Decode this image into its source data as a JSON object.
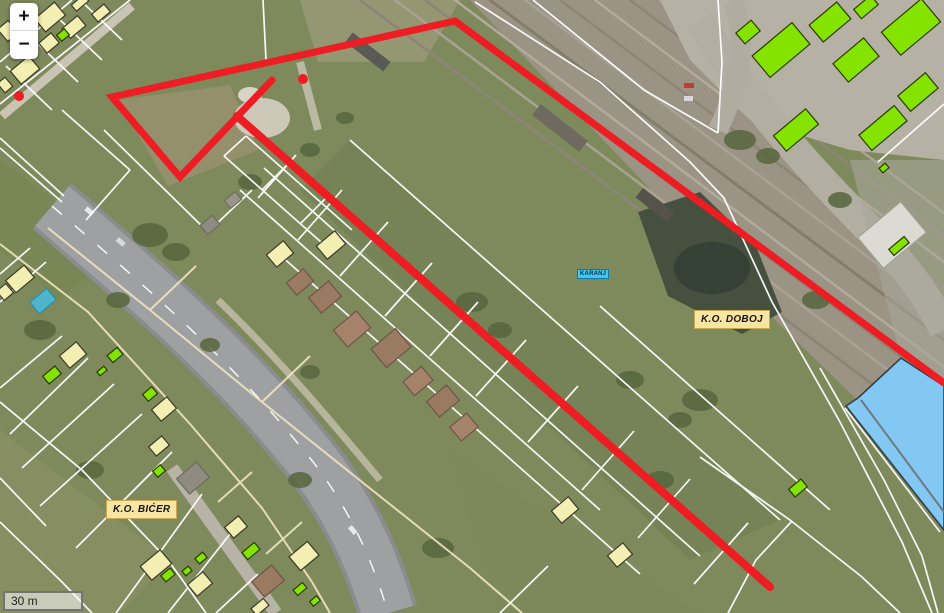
{
  "controls": {
    "zoom_in_label": "+",
    "zoom_out_label": "−"
  },
  "scale_bar": {
    "label": "30 m"
  },
  "labels": {
    "ko_doboj": "K.O. DOBOJ",
    "ko_bicer": "K.O. BIĆER",
    "karanj": "KARANJ"
  },
  "colors": {
    "boundary_red": "#ee1c23",
    "parcel_white": "#ffffff",
    "parcel_cream": "#f2e4c2",
    "building_yellow": "#f3efb2",
    "building_green": "#84e300",
    "building_blue": "#82c8f2",
    "label_bg": "#f8e5a3",
    "hydro_label_bg": "#41c7f0"
  },
  "map_features": {
    "red_boundary": {
      "main_polyline": [
        [
          944,
          383
        ],
        [
          455,
          21
        ],
        [
          112,
          97
        ],
        [
          180,
          177
        ],
        [
          272,
          80
        ]
      ],
      "branch_line": [
        [
          237,
          116
        ],
        [
          770,
          587
        ]
      ],
      "dots": [
        [
          303,
          79
        ],
        [
          19,
          96
        ]
      ]
    },
    "parcel_lines_white": [
      [
        [
          0,
          104
        ],
        [
          130,
          0
        ]
      ],
      [
        [
          0,
          62
        ],
        [
          72,
          0
        ]
      ],
      [
        [
          30,
          36
        ],
        [
          78,
          82
        ]
      ],
      [
        [
          56,
          16
        ],
        [
          102,
          60
        ]
      ],
      [
        [
          80,
          0
        ],
        [
          122,
          40
        ]
      ],
      [
        [
          6,
          66
        ],
        [
          52,
          110
        ]
      ],
      [
        [
          0,
          138
        ],
        [
          64,
          196
        ]
      ],
      [
        [
          62,
          110
        ],
        [
          130,
          170
        ]
      ],
      [
        [
          130,
          170
        ],
        [
          86,
          220
        ]
      ],
      [
        [
          104,
          130
        ],
        [
          208,
          232
        ]
      ],
      [
        [
          208,
          232
        ],
        [
          252,
          190
        ]
      ],
      [
        [
          263,
          0
        ],
        [
          266,
          60
        ]
      ],
      [
        [
          224,
          156
        ],
        [
          330,
          250
        ]
      ],
      [
        [
          246,
          136
        ],
        [
          352,
          230
        ]
      ],
      [
        [
          262,
          190
        ],
        [
          288,
          164
        ]
      ],
      [
        [
          300,
          224
        ],
        [
          326,
          198
        ]
      ],
      [
        [
          224,
          156
        ],
        [
          246,
          136
        ]
      ],
      [
        [
          240,
          190
        ],
        [
          600,
          510
        ]
      ],
      [
        [
          264,
          168
        ],
        [
          700,
          556
        ]
      ],
      [
        [
          280,
          255
        ],
        [
          640,
          574
        ]
      ],
      [
        [
          350,
          140
        ],
        [
          780,
          520
        ]
      ],
      [
        [
          600,
          306
        ],
        [
          830,
          510
        ]
      ],
      [
        [
          298,
          240
        ],
        [
          342,
          190
        ]
      ],
      [
        [
          340,
          276
        ],
        [
          388,
          222
        ]
      ],
      [
        [
          385,
          316
        ],
        [
          432,
          263
        ]
      ],
      [
        [
          430,
          356
        ],
        [
          478,
          302
        ]
      ],
      [
        [
          476,
          396
        ],
        [
          526,
          340
        ]
      ],
      [
        [
          528,
          442
        ],
        [
          578,
          386
        ]
      ],
      [
        [
          582,
          490
        ],
        [
          634,
          431
        ]
      ],
      [
        [
          638,
          538
        ],
        [
          690,
          479
        ]
      ],
      [
        [
          694,
          584
        ],
        [
          748,
          523
        ]
      ],
      [
        [
          258,
          198
        ],
        [
          296,
          155
        ]
      ],
      [
        [
          475,
          2
        ],
        [
          600,
          82
        ],
        [
          690,
          162
        ],
        [
          724,
          198
        ],
        [
          772,
          302
        ],
        [
          840,
          422
        ],
        [
          902,
          542
        ],
        [
          932,
          613
        ]
      ],
      [
        [
          533,
          0
        ],
        [
          644,
          90
        ],
        [
          718,
          133
        ]
      ],
      [
        [
          718,
          133
        ],
        [
          722,
          62
        ],
        [
          718,
          0
        ]
      ],
      [
        [
          878,
          162
        ],
        [
          944,
          104
        ]
      ],
      [
        [
          820,
          368
        ],
        [
          884,
          480
        ],
        [
          922,
          556
        ],
        [
          938,
          613
        ]
      ],
      [
        [
          700,
          457
        ],
        [
          790,
          520
        ],
        [
          862,
          577
        ],
        [
          900,
          613
        ]
      ],
      [
        [
          792,
          521
        ],
        [
          756,
          560
        ],
        [
          728,
          613
        ]
      ],
      [
        [
          845,
          408
        ],
        [
          940,
          532
        ]
      ],
      [
        [
          0,
          402
        ],
        [
          82,
          470
        ],
        [
          168,
          560
        ],
        [
          206,
          613
        ]
      ],
      [
        [
          62,
          336
        ],
        [
          0,
          388
        ]
      ],
      [
        [
          88,
          358
        ],
        [
          10,
          434
        ]
      ],
      [
        [
          114,
          384
        ],
        [
          22,
          468
        ]
      ],
      [
        [
          142,
          414
        ],
        [
          40,
          506
        ]
      ],
      [
        [
          172,
          452
        ],
        [
          76,
          548
        ]
      ],
      [
        [
          202,
          494
        ],
        [
          116,
          613
        ]
      ],
      [
        [
          230,
          534
        ],
        [
          168,
          613
        ]
      ],
      [
        [
          258,
          574
        ],
        [
          216,
          613
        ]
      ],
      [
        [
          46,
          262
        ],
        [
          0,
          302
        ]
      ],
      [
        [
          30,
          248
        ],
        [
          0,
          274
        ]
      ],
      [
        [
          0,
          522
        ],
        [
          62,
          582
        ],
        [
          92,
          613
        ]
      ],
      [
        [
          0,
          478
        ],
        [
          46,
          526
        ]
      ],
      [
        [
          0,
          148
        ],
        [
          62,
          202
        ]
      ],
      [
        [
          500,
          613
        ],
        [
          548,
          566
        ]
      ]
    ],
    "parcel_lines_cream": [
      [
        [
          48,
          228
        ],
        [
          150,
          310
        ],
        [
          262,
          402
        ],
        [
          362,
          482
        ],
        [
          470,
          568
        ],
        [
          522,
          613
        ]
      ],
      [
        [
          0,
          244
        ],
        [
          88,
          312
        ],
        [
          190,
          424
        ],
        [
          262,
          508
        ],
        [
          312,
          582
        ],
        [
          330,
          613
        ]
      ],
      [
        [
          252,
          472
        ],
        [
          218,
          502
        ]
      ],
      [
        [
          302,
          522
        ],
        [
          266,
          554
        ]
      ],
      [
        [
          150,
          310
        ],
        [
          196,
          266
        ]
      ],
      [
        [
          262,
          402
        ],
        [
          310,
          356
        ]
      ]
    ],
    "buildings_yellow": [
      [
        50,
        17,
        26,
        17
      ],
      [
        74,
        27,
        20,
        13
      ],
      [
        101,
        13,
        16,
        10
      ],
      [
        49,
        43,
        16,
        13
      ],
      [
        25,
        70,
        24,
        17
      ],
      [
        8,
        31,
        14,
        16
      ],
      [
        5,
        85,
        10,
        12
      ],
      [
        80,
        3,
        16,
        8
      ],
      [
        20,
        279,
        24,
        16
      ],
      [
        5,
        292,
        12,
        12
      ],
      [
        73,
        355,
        22,
        16
      ],
      [
        164,
        409,
        20,
        15
      ],
      [
        159,
        446,
        17,
        12
      ],
      [
        280,
        254,
        22,
        16
      ],
      [
        331,
        245,
        24,
        17
      ],
      [
        156,
        565,
        26,
        18
      ],
      [
        200,
        584,
        20,
        15
      ],
      [
        236,
        527,
        18,
        14
      ],
      [
        304,
        556,
        24,
        18
      ],
      [
        565,
        510,
        22,
        16
      ],
      [
        620,
        555,
        20,
        15
      ],
      [
        260,
        607,
        16,
        9
      ]
    ],
    "buildings_green": [
      [
        63,
        35,
        10,
        8
      ],
      [
        52,
        375,
        16,
        10
      ],
      [
        115,
        355,
        13,
        9
      ],
      [
        102,
        371,
        9,
        5
      ],
      [
        150,
        394,
        12,
        9
      ],
      [
        159,
        471,
        10,
        8
      ],
      [
        168,
        575,
        12,
        8
      ],
      [
        201,
        558,
        10,
        7
      ],
      [
        187,
        571,
        8,
        6
      ],
      [
        251,
        551,
        16,
        9
      ],
      [
        300,
        589,
        12,
        7
      ],
      [
        315,
        601,
        9,
        6
      ],
      [
        798,
        488,
        16,
        10
      ],
      [
        884,
        168,
        8,
        6
      ],
      [
        899,
        246,
        20,
        8
      ],
      [
        748,
        32,
        20,
        14
      ],
      [
        781,
        50,
        52,
        28
      ],
      [
        830,
        22,
        36,
        22
      ],
      [
        866,
        7,
        22,
        12
      ],
      [
        911,
        27,
        52,
        30
      ],
      [
        856,
        60,
        40,
        24
      ],
      [
        918,
        92,
        36,
        20
      ],
      [
        883,
        128,
        46,
        20
      ],
      [
        796,
        130,
        42,
        20
      ]
    ],
    "buildings_muted": [
      {
        "cx": 193,
        "cy": 478,
        "w": 26,
        "h": 20,
        "fill": "#8f8b80",
        "stroke": "#6e6a60"
      },
      {
        "cx": 210,
        "cy": 225,
        "w": 16,
        "h": 12,
        "fill": "#8f8b80",
        "stroke": "#6e6a60"
      },
      {
        "cx": 233,
        "cy": 200,
        "w": 14,
        "h": 10,
        "fill": "#9a958a",
        "stroke": "#6e6a60"
      },
      {
        "cx": 300,
        "cy": 282,
        "w": 22,
        "h": 16,
        "fill": "#9b7a62",
        "stroke": "#6f5546"
      },
      {
        "cx": 325,
        "cy": 297,
        "w": 26,
        "h": 20,
        "fill": "#9b7a62",
        "stroke": "#6f5546"
      },
      {
        "cx": 352,
        "cy": 329,
        "w": 30,
        "h": 22,
        "fill": "#a5836a",
        "stroke": "#6f5546"
      },
      {
        "cx": 391,
        "cy": 348,
        "w": 32,
        "h": 24,
        "fill": "#9b7a62",
        "stroke": "#6f5546"
      },
      {
        "cx": 418,
        "cy": 381,
        "w": 24,
        "h": 18,
        "fill": "#a5836a",
        "stroke": "#6f5546"
      },
      {
        "cx": 443,
        "cy": 401,
        "w": 26,
        "h": 20,
        "fill": "#9b7a62",
        "stroke": "#6f5546"
      },
      {
        "cx": 464,
        "cy": 427,
        "w": 22,
        "h": 18,
        "fill": "#a5836a",
        "stroke": "#6f5546"
      },
      {
        "cx": 268,
        "cy": 581,
        "w": 26,
        "h": 20,
        "fill": "#9b7a62",
        "stroke": "#6f5546"
      },
      {
        "cx": 892,
        "cy": 235,
        "w": 56,
        "h": 40,
        "fill": "#dbdbd3",
        "stroke": "#a0a096"
      },
      {
        "cx": 43,
        "cy": 301,
        "w": 22,
        "h": 15,
        "fill": "#4db4cc",
        "stroke": "#2e8aa0"
      }
    ],
    "building_blue": {
      "points": [
        [
          901,
          358
        ],
        [
          944,
          386
        ],
        [
          944,
          530
        ],
        [
          846,
          406
        ],
        [
          858,
          398
        ]
      ],
      "ridge": [
        [
          861,
          400
        ],
        [
          944,
          512
        ]
      ]
    }
  }
}
